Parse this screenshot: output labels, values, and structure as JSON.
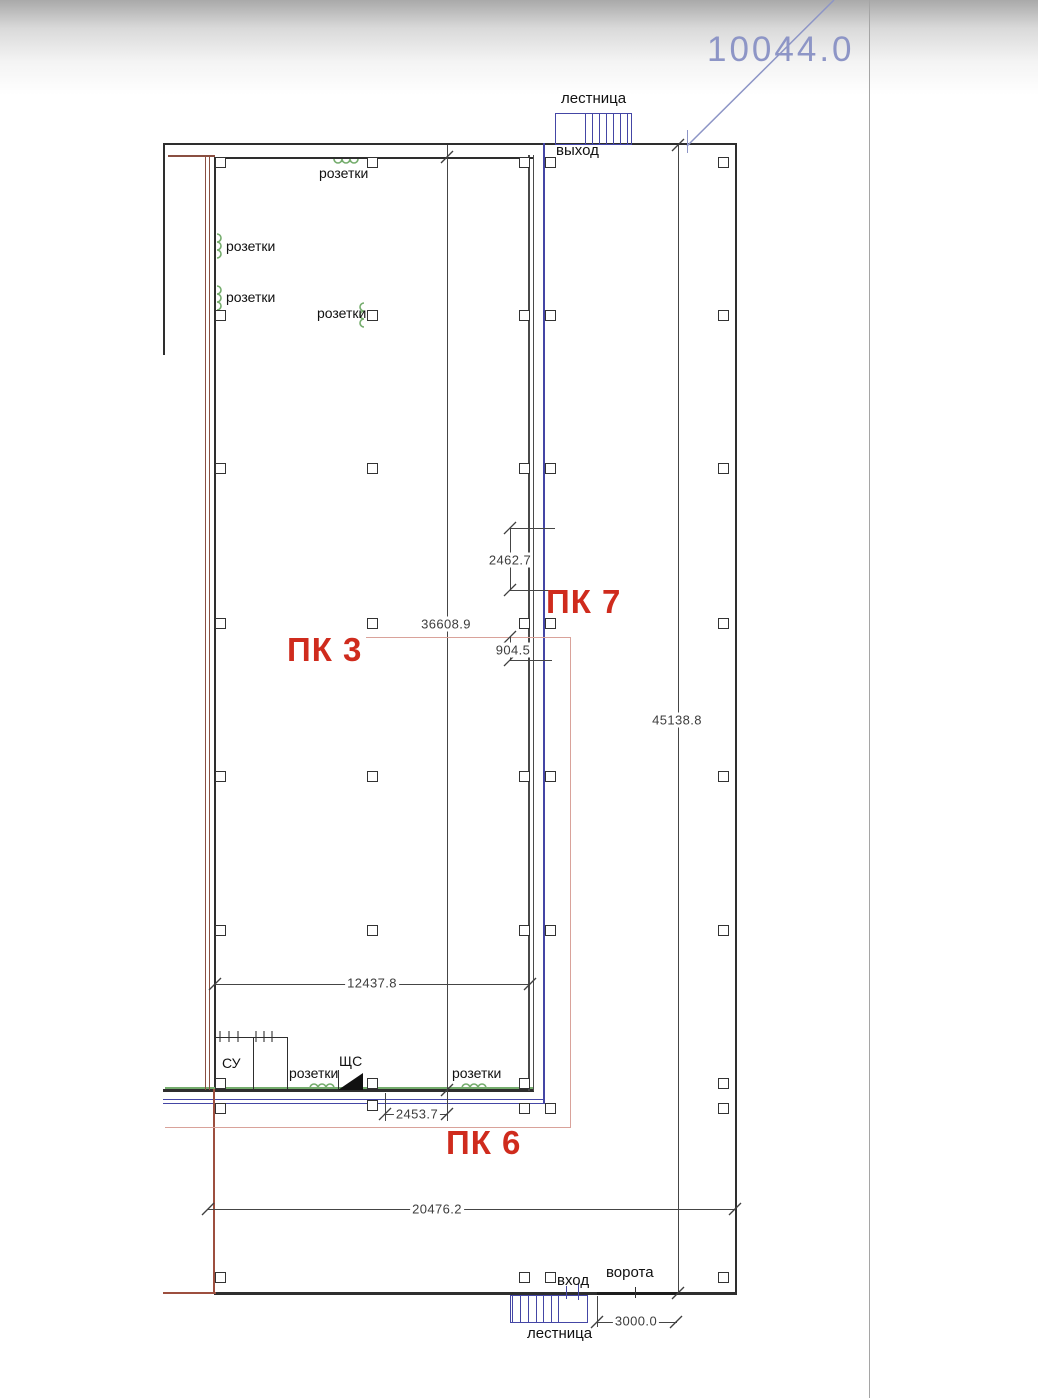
{
  "drawing": {
    "labels": {
      "stair_top": "лестница",
      "exit": "выход",
      "outlets": "розетки",
      "bathroom": "СУ",
      "panel": "ЩС",
      "entrance": "вход",
      "gate": "ворота",
      "stair_bottom": "лестница"
    },
    "markers": {
      "pk3": "ПК 3",
      "pk7": "ПК 7",
      "pk6": "ПК 6"
    },
    "dimensions": {
      "top_leader": "10044.0",
      "seg_2462": "2462.7",
      "hall_height": "36608.9",
      "seg_904": "904.5",
      "right_height": "45138.8",
      "hall_width": "12437.8",
      "seg_2453": "2453.7",
      "bottom_width": "20476.2",
      "gate_width": "3000.0"
    },
    "colors": {
      "marker_red": "#cf2b1d",
      "outline_pink": "#d9a29a",
      "boundary_maroon": "#8a4f41",
      "stair_blue": "#4446a5",
      "outlet_green": "#74ac6c",
      "leader_blue": "#8d95c6",
      "wall_dark": "#2e2e2e"
    }
  }
}
